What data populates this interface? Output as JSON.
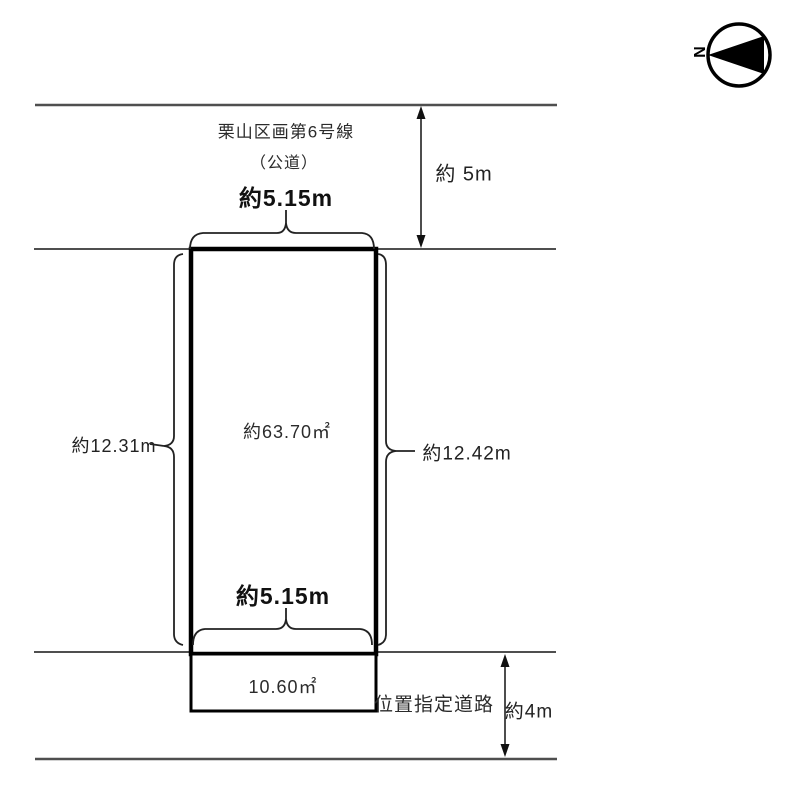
{
  "compass": {
    "label": "N"
  },
  "top_road": {
    "name": "栗山区画第6号線",
    "type": "（公道）",
    "width": "約 5m"
  },
  "parcel": {
    "top_frontage": "約5.15m",
    "area": "約63.70㎡",
    "left_side": "約12.31m",
    "right_side": "約12.42m",
    "bottom_frontage": "約5.15m"
  },
  "extension": {
    "area": "10.60㎡"
  },
  "bottom_road": {
    "name": "位置指定道路",
    "width": "約4m"
  },
  "colors": {
    "road_line": "#4f4f4f",
    "plot_border": "#000000",
    "brace": "#222222",
    "text": "#2b2b2b"
  }
}
